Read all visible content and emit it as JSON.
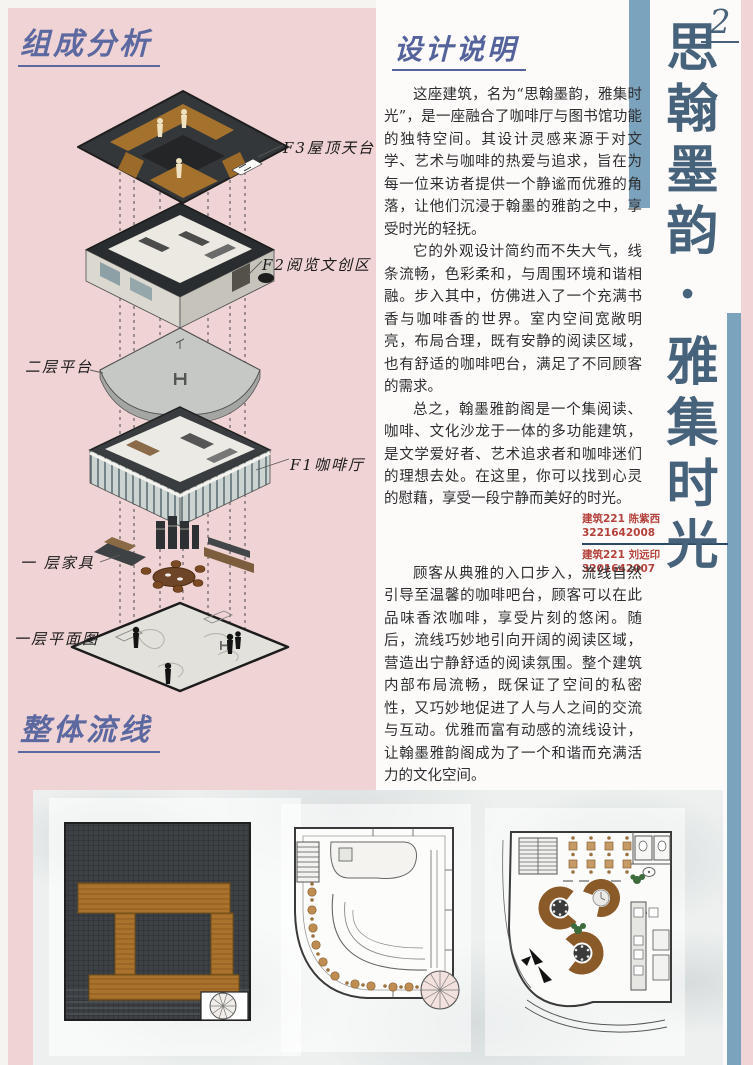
{
  "page": {
    "number": "2",
    "vertical_title": "思翰墨韵·雅集时光"
  },
  "sections": {
    "composition": {
      "heading": "组成分析"
    },
    "design_notes": {
      "heading": "设计说明",
      "paragraphs": [
        "这座建筑，名为“思翰墨韵，雅集时光”，是一座融合了咖啡厅与图书馆功能的独特空间。其设计灵感来源于对文学、艺术与咖啡的热爱与追求，旨在为每一位来访者提供一个静谧而优雅的角落，让他们沉浸于翰墨的雅韵之中，享受时光的轻抚。",
        "它的外观设计简约而不失大气，线条流畅，色彩柔和，与周围环境和谐相融。步入其中，仿佛进入了一个充满书香与咖啡香的世界。室内空间宽敞明亮，布局合理，既有安静的阅读区域，也有舒适的咖啡吧台，满足了不同顾客的需求。",
        "总之，翰墨雅韵阁是一个集阅读、咖啡、文化沙龙于一体的多功能建筑，是文学爱好者、艺术追求者和咖啡迷们的理想去处。在这里，你可以找到心灵的慰藉，享受一段宁静而美好的时光。"
      ]
    },
    "circulation": {
      "heading": "整体流线",
      "paragraph": "顾客从典雅的入口步入，流线自然引导至温馨的咖啡吧台，顾客可以在此品味香浓咖啡，享受片刻的悠闲。随后，流线巧妙地引向开阔的阅读区域，营造出宁静舒适的阅读氛围。整个建筑内部布局流畅，既保证了空间的私密性，又巧妙地促进了人与人之间的交流与互动。优雅而富有动感的流线设计，让翰墨雅韵阁成为了一个和谐而充满活力的文化空间。"
    }
  },
  "axon_labels": [
    {
      "text": "F3屋顶天台"
    },
    {
      "text": "F2阅览文创区"
    },
    {
      "text": "二层平台"
    },
    {
      "text": "F1咖啡厅"
    },
    {
      "text": "一 层家具"
    },
    {
      "text": "一层平面图"
    }
  ],
  "credits": {
    "line1": "建筑221 陈紫西 3221642008",
    "line2": "建筑221 刘远印 3201642007"
  },
  "colors": {
    "panel_pink": "#f0d3d4",
    "accent_blue": "#7ba3bd",
    "title_slate": "#47637b",
    "heading_blue": "#5c68a0",
    "credit_red": "#b5413c",
    "wood": "#a9722d",
    "roof_dark": "#3d4044"
  }
}
